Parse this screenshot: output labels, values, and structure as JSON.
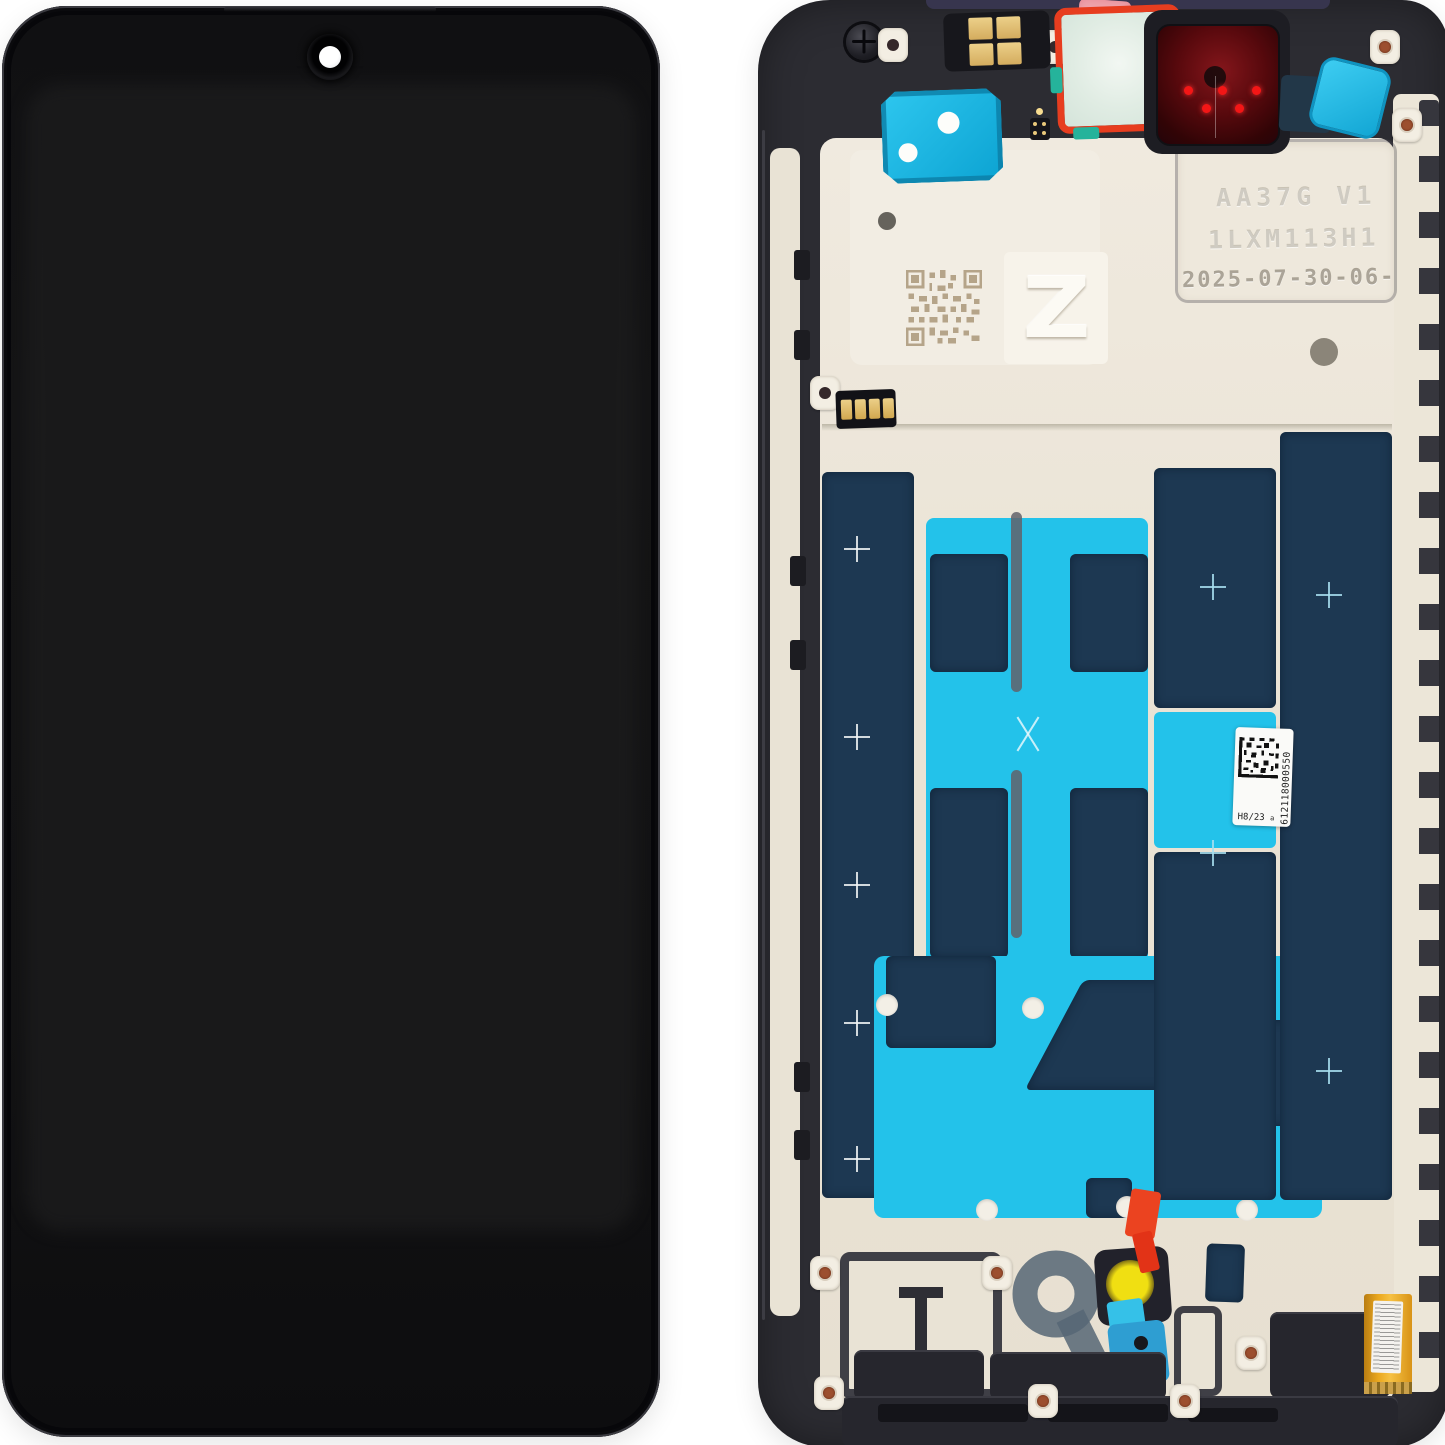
{
  "scene": {
    "type": "product-photo",
    "subject": "Smartphone LCD display assembly with frame - front view (left) and rear frame view (right)",
    "background_color": "#ffffff"
  },
  "front_view": {
    "camera": "punch-hole camera, top center"
  },
  "back_view": {
    "etched_line1": "AA37G V1",
    "etched_line2": "1LXM113H1",
    "etched_date_code": "2025-07-30-06-228",
    "plate_letter": "Z",
    "service_label": {
      "serial": "612118000550",
      "batch": "H8/23",
      "rev": "a"
    },
    "colors": {
      "frame": "#2c2c32",
      "backplate": "#ebe5d7",
      "adhesive_navy": "#1d3852",
      "adhesive_cyan": "#23c2ea",
      "sticker_mint": "#e3eee6",
      "sticker_border_red": "#e73d1f",
      "sticker_pink": "#eea3ab",
      "camera_window_red": "#58090d",
      "contact_gold": "#e3c579",
      "motor_yellow": "#f0df12",
      "pull_tab_red": "#eb4320",
      "ring_gray": "#5a6a7a",
      "flex_orange": "#eaa81f"
    }
  }
}
